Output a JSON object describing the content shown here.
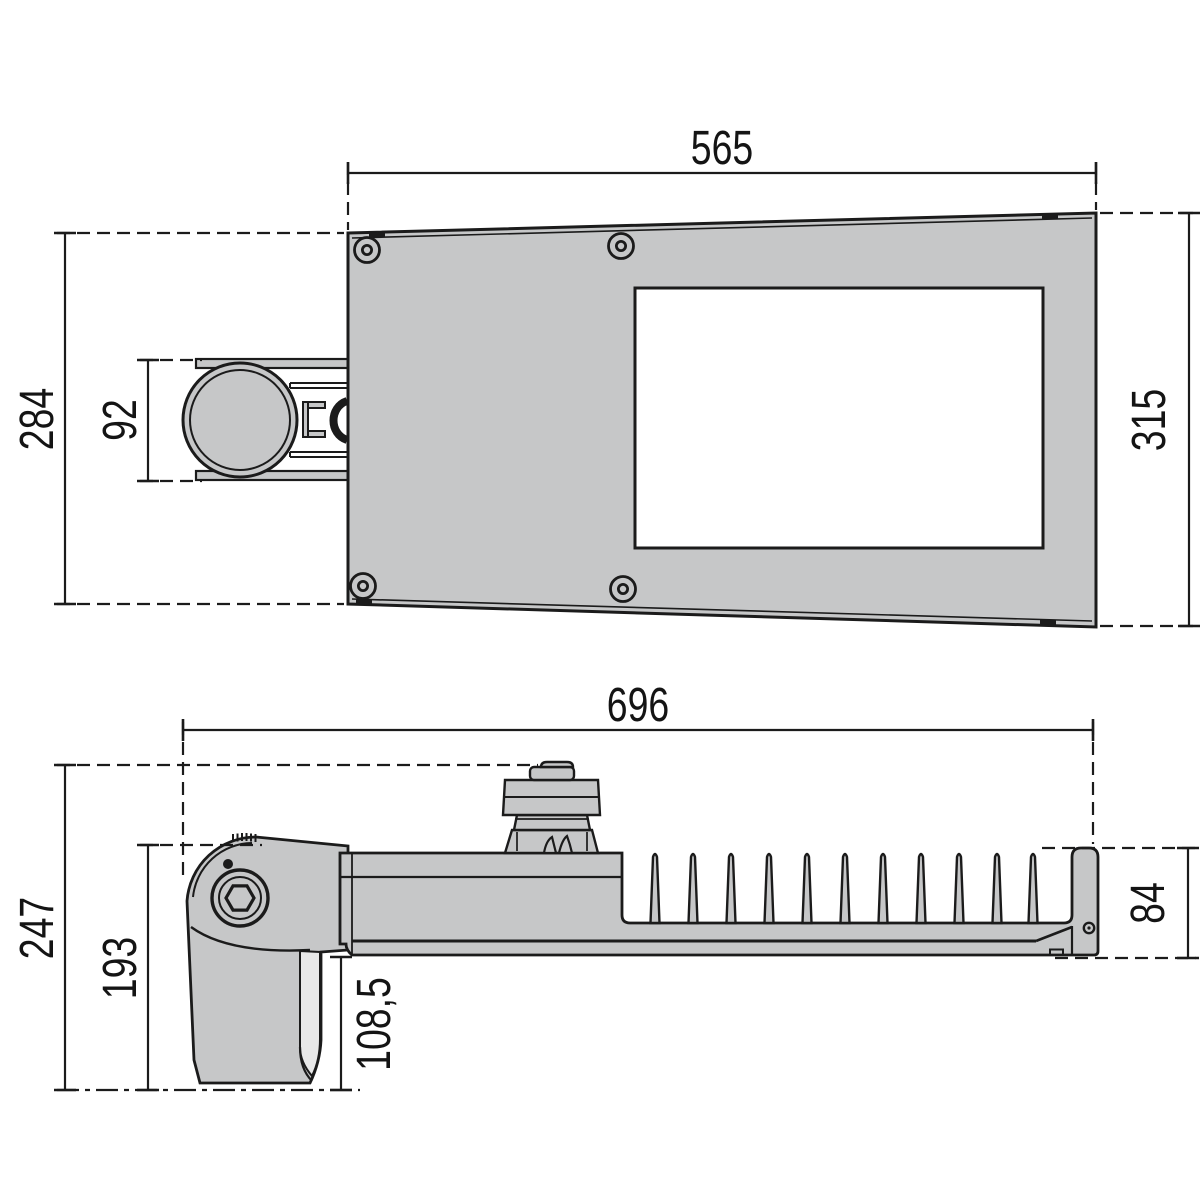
{
  "drawing": {
    "type": "luminaire-dimensional-drawing",
    "views": {
      "top_view": {
        "dims": {
          "width_top": "565",
          "height_left": "284",
          "arm_width": "92",
          "height_right": "315"
        }
      },
      "side_view": {
        "dims": {
          "length": "696",
          "height_total": "247",
          "height_bracket": "193",
          "height_underside": "108,5",
          "height_body": "84"
        }
      }
    },
    "colors": {
      "body_fill": "#c6c7c8",
      "line": "#1b1b1b",
      "window_fill": "#ffffff",
      "wedge_fill": "#e8e8e8"
    },
    "icons": [
      "screw-icon",
      "hex-bolt-icon",
      "end-cap-screw-icon"
    ]
  }
}
